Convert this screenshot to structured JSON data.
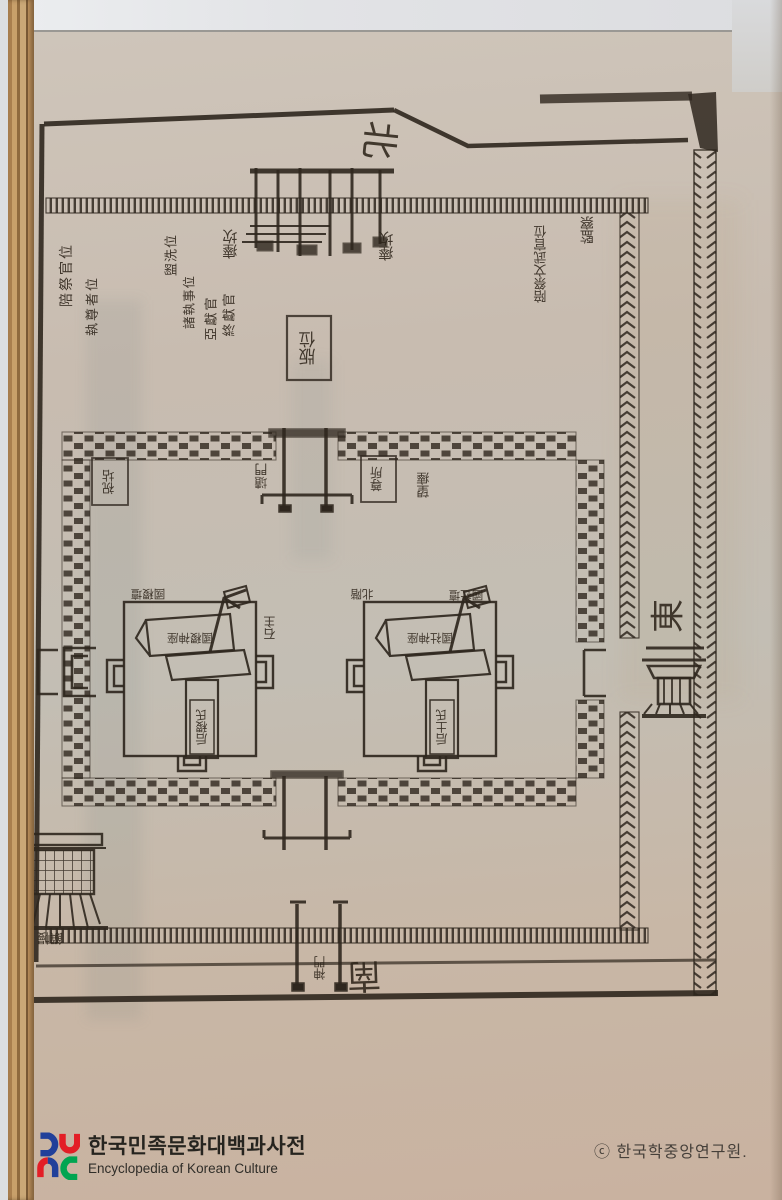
{
  "directions": {
    "north": "北",
    "east": "東",
    "south": "南"
  },
  "diagram_labels": {
    "pit_left": "瘞坎",
    "pit_right": "瘞坎",
    "monitor": "監察",
    "attendants_ne": "陪祭文武官位",
    "col_baeje": "陪祭官位",
    "col_jipjon": "執尊者位",
    "col_gwanse": "盥洗位",
    "col_jejipsa": "諸執事位",
    "col_aheon": "亞獻官",
    "col_jongheon": "終獻官",
    "panwi": "版位",
    "box_west": "祝坫",
    "box_east": "尊所",
    "inner_gate": "壝門",
    "wangye": "望瘞",
    "seokju": "石主",
    "altar_left_name": "國稷壇",
    "stair": "北階",
    "altar_right_name": "國社壇",
    "banner_left": "國稷神座",
    "banner_right": "國社神座",
    "tablet_left": "后稷氏",
    "tablet_right": "后土氏",
    "tent": "饌幔",
    "south_gate": "神門"
  },
  "watermark": {
    "korean": "한국민족문화대백과사전",
    "english": "Encyclopedia of Korean Culture"
  },
  "copyright": "ⓒ 한국학중앙연구원.",
  "colors": {
    "paper": "#c8bcb0",
    "ink": "#2f271e",
    "logo_blue": "#21409a",
    "logo_red": "#e31e26",
    "logo_green": "#00a551"
  }
}
